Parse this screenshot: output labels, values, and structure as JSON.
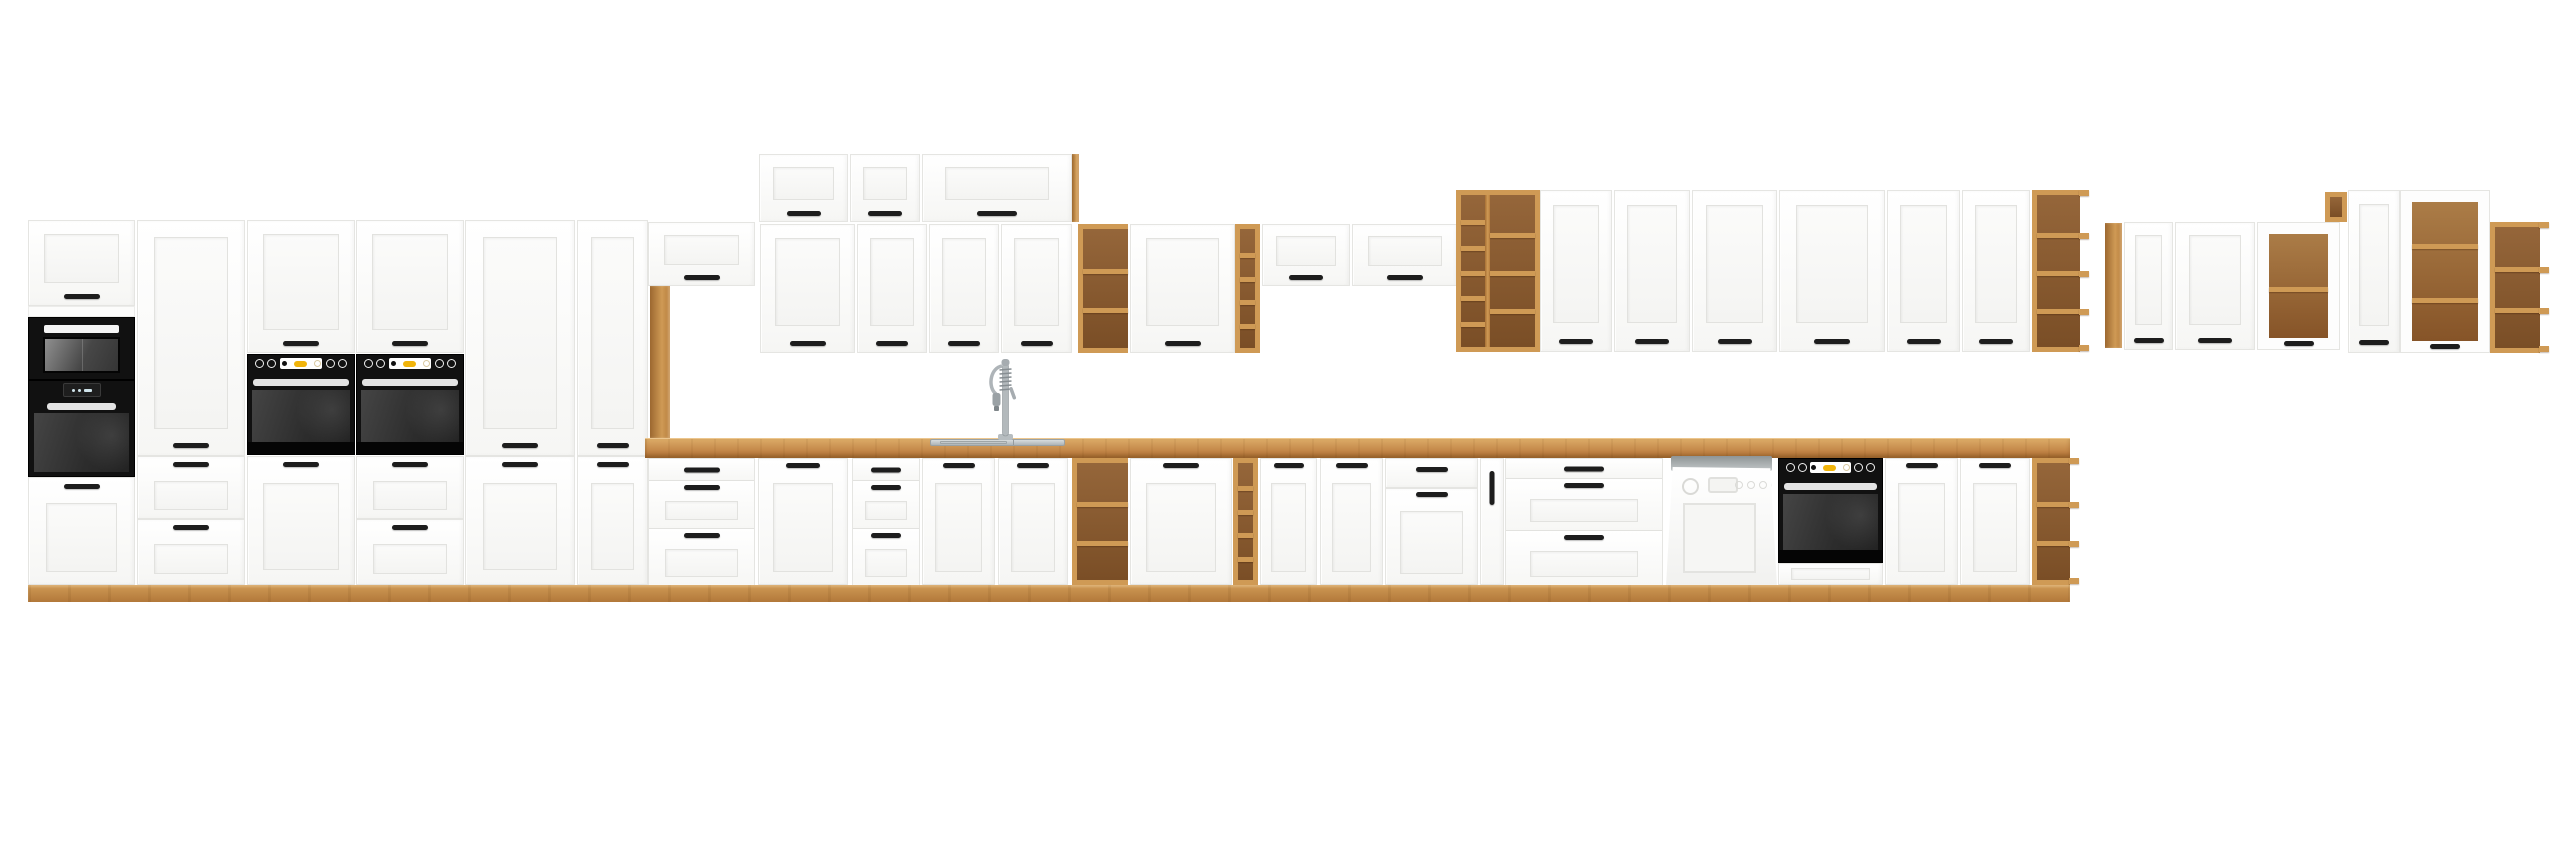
{
  "image": {
    "width": 2560,
    "height": 848,
    "background": "#ffffff",
    "subject": "white-and-oak-kitchen-cabinet-set"
  },
  "colors": {
    "oak-light": "#cf9a55",
    "oak": "#c4884a",
    "oak-dark": "#8a5a2e",
    "oak-deep": "#6e4520",
    "front": "#fdfdfd",
    "line": "#e5e5e2",
    "handle": "#1d1d1d",
    "appliance": "#161616",
    "glass": "#3a3a3a",
    "steel": "#c3c8cb",
    "accent-yellow": "#f1b40a",
    "dw-gray": "#b7bcbd"
  },
  "units": [
    {
      "name": "tall-oven-unit-top-door",
      "type": "door",
      "x": 28,
      "y": 220,
      "w": 107,
      "h": 86,
      "panel": [
        15,
        13,
        15,
        22
      ],
      "handle": {
        "side": "bottom",
        "w": 36,
        "off": 6
      }
    },
    {
      "name": "tall-oven-unit-filler",
      "type": "filler",
      "x": 28,
      "y": 306,
      "w": 107,
      "h": 11
    },
    {
      "name": "microwave",
      "type": "microwave",
      "x": 28,
      "y": 317,
      "w": 107,
      "h": 63
    },
    {
      "name": "built-in-oven-tall",
      "type": "oven-display",
      "x": 28,
      "y": 380,
      "w": 107,
      "h": 97
    },
    {
      "name": "tall-oven-unit-base-door",
      "type": "door",
      "x": 28,
      "y": 477,
      "w": 107,
      "h": 108,
      "panel": [
        17,
        25,
        17,
        12
      ],
      "handle": {
        "side": "top",
        "w": 36,
        "off": 6
      }
    },
    {
      "name": "pantry-upper-door",
      "type": "door",
      "x": 137,
      "y": 220,
      "w": 108,
      "h": 236,
      "panel": [
        16,
        16,
        16,
        26
      ],
      "handle": {
        "side": "bottom",
        "w": 36,
        "off": 7
      }
    },
    {
      "name": "pantry-drawer-1",
      "type": "door",
      "x": 137,
      "y": 456,
      "w": 108,
      "h": 63,
      "panel": [
        16,
        24,
        16,
        8
      ],
      "handle": {
        "side": "top",
        "w": 36,
        "off": 5
      }
    },
    {
      "name": "pantry-drawer-2",
      "type": "door",
      "x": 137,
      "y": 519,
      "w": 108,
      "h": 66,
      "panel": [
        16,
        24,
        16,
        10
      ],
      "handle": {
        "side": "top",
        "w": 36,
        "off": 5
      }
    },
    {
      "name": "oven-column-1-wall-door",
      "type": "door",
      "x": 247,
      "y": 220,
      "w": 108,
      "h": 133,
      "panel": [
        15,
        13,
        15,
        22
      ],
      "handle": {
        "side": "bottom",
        "w": 36,
        "off": 6
      }
    },
    {
      "name": "built-in-oven-1",
      "type": "oven",
      "x": 247,
      "y": 354,
      "w": 108,
      "h": 101
    },
    {
      "name": "oven-column-1-base-door",
      "type": "door",
      "x": 247,
      "y": 456,
      "w": 108,
      "h": 129,
      "panel": [
        15,
        26,
        15,
        14
      ],
      "handle": {
        "side": "top",
        "w": 36,
        "off": 5
      }
    },
    {
      "name": "oven-column-2-wall-door",
      "type": "door",
      "x": 356,
      "y": 220,
      "w": 108,
      "h": 133,
      "panel": [
        15,
        13,
        15,
        22
      ],
      "handle": {
        "side": "bottom",
        "w": 36,
        "off": 6
      }
    },
    {
      "name": "built-in-oven-2",
      "type": "oven",
      "x": 356,
      "y": 354,
      "w": 108,
      "h": 101
    },
    {
      "name": "oven-column-2-drawer-1",
      "type": "door",
      "x": 356,
      "y": 456,
      "w": 108,
      "h": 63,
      "panel": [
        16,
        24,
        16,
        8
      ],
      "handle": {
        "side": "top",
        "w": 36,
        "off": 5
      }
    },
    {
      "name": "oven-column-2-drawer-2",
      "type": "door",
      "x": 356,
      "y": 519,
      "w": 108,
      "h": 66,
      "panel": [
        16,
        24,
        16,
        10
      ],
      "handle": {
        "side": "top",
        "w": 36,
        "off": 5
      }
    },
    {
      "name": "tall-cabinet-1-upper-door",
      "type": "door",
      "x": 465,
      "y": 220,
      "w": 110,
      "h": 236,
      "panel": [
        17,
        16,
        17,
        26
      ],
      "handle": {
        "side": "bottom",
        "w": 36,
        "off": 7
      }
    },
    {
      "name": "tall-cabinet-1-lower-door",
      "type": "door",
      "x": 465,
      "y": 456,
      "w": 110,
      "h": 129,
      "panel": [
        17,
        26,
        17,
        14
      ],
      "handle": {
        "side": "top",
        "w": 36,
        "off": 5
      }
    },
    {
      "name": "tall-cabinet-2-upper-door",
      "type": "door",
      "x": 577,
      "y": 220,
      "w": 71,
      "h": 236,
      "panel": [
        13,
        16,
        13,
        26
      ],
      "handle": {
        "side": "bottom",
        "w": 32,
        "off": 7
      }
    },
    {
      "name": "tall-cabinet-2-lower-door",
      "type": "door",
      "x": 577,
      "y": 456,
      "w": 71,
      "h": 129,
      "panel": [
        13,
        26,
        13,
        14
      ],
      "handle": {
        "side": "top",
        "w": 32,
        "off": 5
      }
    },
    {
      "name": "wall-cabinet-over-post",
      "type": "door",
      "x": 648,
      "y": 222,
      "w": 107,
      "h": 64,
      "panel": [
        15,
        12,
        15,
        20
      ],
      "handle": {
        "side": "bottom",
        "w": 36,
        "off": 5
      }
    },
    {
      "name": "oak-post",
      "type": "oak-panel",
      "x": 650,
      "y": 286,
      "w": 20,
      "h": 152
    },
    {
      "name": "wall-top-cabinet-1",
      "type": "door",
      "x": 759,
      "y": 154,
      "w": 89,
      "h": 68,
      "panel": [
        13,
        12,
        13,
        21
      ],
      "handle": {
        "side": "bottom",
        "w": 34,
        "off": 5
      }
    },
    {
      "name": "wall-top-cabinet-2",
      "type": "door",
      "x": 850,
      "y": 154,
      "w": 70,
      "h": 68,
      "panel": [
        12,
        12,
        12,
        21
      ],
      "handle": {
        "side": "bottom",
        "w": 34,
        "off": 5
      }
    },
    {
      "name": "wall-top-cabinet-3",
      "type": "door",
      "x": 922,
      "y": 154,
      "w": 150,
      "h": 68,
      "panel": [
        22,
        12,
        22,
        21
      ],
      "handle": {
        "side": "bottom",
        "w": 40,
        "off": 5
      }
    },
    {
      "name": "wall-top-oak-end-panel",
      "type": "oak-panel",
      "x": 1072,
      "y": 154,
      "w": 7,
      "h": 68
    },
    {
      "name": "wall-door-1",
      "type": "door",
      "x": 760,
      "y": 224,
      "w": 95,
      "h": 129,
      "panel": [
        14,
        13,
        14,
        26
      ],
      "handle": {
        "side": "bottom",
        "w": 36,
        "off": 6
      }
    },
    {
      "name": "wall-door-2",
      "type": "door",
      "x": 857,
      "y": 224,
      "w": 70,
      "h": 129,
      "panel": [
        12,
        13,
        12,
        26
      ],
      "handle": {
        "side": "bottom",
        "w": 32,
        "off": 6
      }
    },
    {
      "name": "wall-door-3",
      "type": "door",
      "x": 929,
      "y": 224,
      "w": 70,
      "h": 129,
      "panel": [
        12,
        13,
        12,
        26
      ],
      "handle": {
        "side": "bottom",
        "w": 32,
        "off": 6
      }
    },
    {
      "name": "wall-door-4",
      "type": "door",
      "x": 1001,
      "y": 224,
      "w": 71,
      "h": 129,
      "panel": [
        12,
        13,
        12,
        26
      ],
      "handle": {
        "side": "bottom",
        "w": 32,
        "off": 6
      }
    },
    {
      "name": "wall-open-shelf",
      "type": "shelf-unit",
      "x": 1078,
      "y": 224,
      "w": 50,
      "h": 129,
      "cells": 3,
      "openRight": true
    },
    {
      "name": "wall-door-5",
      "type": "door",
      "x": 1130,
      "y": 224,
      "w": 105,
      "h": 129,
      "panel": [
        15,
        13,
        15,
        26
      ],
      "handle": {
        "side": "bottom",
        "w": 36,
        "off": 6
      }
    },
    {
      "name": "wall-oak-column",
      "type": "shelf-unit",
      "x": 1235,
      "y": 224,
      "w": 25,
      "h": 129,
      "cells": 5
    },
    {
      "name": "wall-cabinet-short-1",
      "type": "door",
      "x": 1262,
      "y": 224,
      "w": 88,
      "h": 62,
      "panel": [
        13,
        11,
        13,
        19
      ],
      "handle": {
        "side": "bottom",
        "w": 34,
        "off": 5
      }
    },
    {
      "name": "wall-cabinet-short-2",
      "type": "door",
      "x": 1352,
      "y": 224,
      "w": 106,
      "h": 62,
      "panel": [
        15,
        11,
        15,
        19
      ],
      "handle": {
        "side": "bottom",
        "w": 36,
        "off": 5
      }
    },
    {
      "name": "oak-shelf-tower",
      "type": "oak-tower",
      "x": 1456,
      "y": 190,
      "w": 84,
      "h": 162
    },
    {
      "name": "wall-tall-door-1",
      "type": "door",
      "x": 1540,
      "y": 190,
      "w": 72,
      "h": 162,
      "panel": [
        12,
        14,
        12,
        28
      ],
      "handle": {
        "side": "bottom",
        "w": 34,
        "off": 7
      }
    },
    {
      "name": "wall-tall-door-2",
      "type": "door",
      "x": 1614,
      "y": 190,
      "w": 76,
      "h": 162,
      "panel": [
        12,
        14,
        12,
        28
      ],
      "handle": {
        "side": "bottom",
        "w": 34,
        "off": 7
      }
    },
    {
      "name": "wall-tall-door-3",
      "type": "door",
      "x": 1692,
      "y": 190,
      "w": 85,
      "h": 162,
      "panel": [
        13,
        14,
        13,
        28
      ],
      "handle": {
        "side": "bottom",
        "w": 34,
        "off": 7
      }
    },
    {
      "name": "wall-tall-door-4",
      "type": "door",
      "x": 1779,
      "y": 190,
      "w": 106,
      "h": 162,
      "panel": [
        16,
        14,
        16,
        28
      ],
      "handle": {
        "side": "bottom",
        "w": 36,
        "off": 7
      }
    },
    {
      "name": "wall-tall-door-5",
      "type": "door",
      "x": 1887,
      "y": 190,
      "w": 73,
      "h": 162,
      "panel": [
        12,
        14,
        12,
        28
      ],
      "handle": {
        "side": "bottom",
        "w": 34,
        "off": 7
      }
    },
    {
      "name": "wall-tall-door-6",
      "type": "door",
      "x": 1962,
      "y": 190,
      "w": 68,
      "h": 162,
      "panel": [
        12,
        14,
        12,
        28
      ],
      "handle": {
        "side": "bottom",
        "w": 34,
        "off": 7
      }
    },
    {
      "name": "wall-oak-end-shelf",
      "type": "shelf-unit",
      "x": 2032,
      "y": 190,
      "w": 48,
      "h": 162,
      "cells": 4,
      "openRight": true,
      "lips": true
    },
    {
      "name": "right-group-oak-side-panel",
      "type": "oak-panel",
      "x": 2105,
      "y": 223,
      "w": 17,
      "h": 125
    },
    {
      "name": "right-wall-door-1",
      "type": "door",
      "x": 2124,
      "y": 222,
      "w": 49,
      "h": 128,
      "panel": [
        10,
        12,
        10,
        24
      ],
      "handle": {
        "side": "bottom",
        "w": 30,
        "off": 6
      }
    },
    {
      "name": "right-wall-door-2",
      "type": "door",
      "x": 2175,
      "y": 222,
      "w": 80,
      "h": 128,
      "panel": [
        13,
        12,
        13,
        24
      ],
      "handle": {
        "side": "bottom",
        "w": 34,
        "off": 6
      }
    },
    {
      "name": "right-display-cabinet-1",
      "type": "vitrine",
      "x": 2257,
      "y": 222,
      "w": 83,
      "h": 128,
      "shelves": [
        0.5
      ]
    },
    {
      "name": "right-oak-mini-shelf",
      "type": "shelf-unit",
      "x": 2325,
      "y": 192,
      "w": 22,
      "h": 30,
      "cells": 1
    },
    {
      "name": "right2-wall-door",
      "type": "door",
      "x": 2348,
      "y": 190,
      "w": 52,
      "h": 163,
      "panel": [
        10,
        13,
        10,
        26
      ],
      "handle": {
        "side": "bottom",
        "w": 30,
        "off": 7
      }
    },
    {
      "name": "right-display-cabinet-2",
      "type": "vitrine",
      "x": 2400,
      "y": 190,
      "w": 90,
      "h": 163,
      "shelves": [
        0.3,
        0.68
      ]
    },
    {
      "name": "right-oak-corner-shelf",
      "type": "shelf-unit",
      "x": 2490,
      "y": 222,
      "w": 50,
      "h": 131,
      "cells": 3,
      "openRight": true,
      "lips": true
    },
    {
      "name": "countertop",
      "type": "countertop",
      "x": 645,
      "y": 438,
      "w": 1425,
      "h": 20
    },
    {
      "name": "sink",
      "type": "sink",
      "x": 930,
      "y": 439,
      "w": 135,
      "h": 7
    },
    {
      "name": "kitchen-faucet",
      "type": "faucet",
      "x": 985,
      "y": 357,
      "w": 40,
      "h": 83
    },
    {
      "name": "base-drawers-1",
      "type": "drawers3",
      "x": 648,
      "y": 458,
      "w": 107,
      "h": 127,
      "rows": [
        22,
        48,
        57
      ],
      "hw": 36,
      "pw": 16
    },
    {
      "name": "base-door-1",
      "type": "door",
      "x": 758,
      "y": 458,
      "w": 90,
      "h": 127,
      "panel": [
        14,
        24,
        14,
        12
      ],
      "handle": {
        "side": "top",
        "w": 34,
        "off": 4
      }
    },
    {
      "name": "base-drawers-2",
      "type": "drawers3",
      "x": 852,
      "y": 458,
      "w": 68,
      "h": 127,
      "rows": [
        22,
        48,
        57
      ],
      "hw": 30,
      "pw": 12
    },
    {
      "name": "sink-base-door-1",
      "type": "door",
      "x": 922,
      "y": 458,
      "w": 73,
      "h": 127,
      "panel": [
        12,
        24,
        12,
        12
      ],
      "handle": {
        "side": "top",
        "w": 32,
        "off": 4
      }
    },
    {
      "name": "sink-base-door-2",
      "type": "door",
      "x": 998,
      "y": 458,
      "w": 70,
      "h": 127,
      "panel": [
        12,
        24,
        12,
        12
      ],
      "handle": {
        "side": "top",
        "w": 32,
        "off": 4
      }
    },
    {
      "name": "base-open-shelf",
      "type": "shelf-unit",
      "x": 1072,
      "y": 458,
      "w": 56,
      "h": 127,
      "cells": 3,
      "openRight": true
    },
    {
      "name": "base-door-2",
      "type": "door",
      "x": 1130,
      "y": 458,
      "w": 102,
      "h": 127,
      "panel": [
        15,
        24,
        15,
        12
      ],
      "handle": {
        "side": "top",
        "w": 36,
        "off": 4
      }
    },
    {
      "name": "base-oak-column",
      "type": "shelf-unit",
      "x": 1233,
      "y": 458,
      "w": 25,
      "h": 127,
      "cells": 5
    },
    {
      "name": "base-door-3",
      "type": "door",
      "x": 1260,
      "y": 458,
      "w": 57,
      "h": 127,
      "panel": [
        10,
        24,
        10,
        12
      ],
      "handle": {
        "side": "top",
        "w": 30,
        "off": 4
      }
    },
    {
      "name": "base-door-4",
      "type": "door",
      "x": 1320,
      "y": 458,
      "w": 63,
      "h": 127,
      "panel": [
        11,
        24,
        11,
        12
      ],
      "handle": {
        "side": "top",
        "w": 32,
        "off": 4
      }
    },
    {
      "name": "base-combi-top-drawer",
      "type": "door",
      "x": 1385,
      "y": 458,
      "w": 93,
      "h": 30,
      "handle": {
        "side": "top",
        "w": 32,
        "off": 8
      }
    },
    {
      "name": "base-combi-door",
      "type": "door",
      "x": 1385,
      "y": 488,
      "w": 93,
      "h": 97,
      "panel": [
        14,
        22,
        14,
        10
      ],
      "handle": {
        "side": "top",
        "w": 32,
        "off": 3
      }
    },
    {
      "name": "base-cargo-door",
      "type": "door",
      "x": 1480,
      "y": 458,
      "w": 24,
      "h": 127,
      "handle": {
        "side": "vert",
        "w": 34,
        "off": 12
      }
    },
    {
      "name": "base-drawers-wide",
      "type": "drawers3",
      "x": 1505,
      "y": 458,
      "w": 158,
      "h": 127,
      "rows": [
        20,
        52,
        55
      ],
      "hw": 40,
      "pw": 24
    },
    {
      "name": "dishwasher",
      "type": "dishwasher",
      "x": 1665,
      "y": 456,
      "w": 115,
      "h": 130
    },
    {
      "name": "built-in-oven-base",
      "type": "oven",
      "x": 1778,
      "y": 458,
      "w": 105,
      "h": 105
    },
    {
      "name": "oven-base-drawer",
      "type": "door",
      "x": 1778,
      "y": 563,
      "w": 105,
      "h": 22,
      "panel": [
        12,
        4,
        12,
        4
      ]
    },
    {
      "name": "base-door-5",
      "type": "door",
      "x": 1885,
      "y": 458,
      "w": 73,
      "h": 127,
      "panel": [
        12,
        24,
        12,
        12
      ],
      "handle": {
        "side": "top",
        "w": 32,
        "off": 4
      }
    },
    {
      "name": "base-door-6",
      "type": "door",
      "x": 1960,
      "y": 458,
      "w": 70,
      "h": 127,
      "panel": [
        12,
        24,
        12,
        12
      ],
      "handle": {
        "side": "top",
        "w": 32,
        "off": 4
      }
    },
    {
      "name": "base-oak-end-shelf",
      "type": "shelf-unit",
      "x": 2032,
      "y": 458,
      "w": 38,
      "h": 127,
      "cells": 3,
      "openRight": true,
      "lips": true
    },
    {
      "name": "plinth",
      "type": "plinth",
      "x": 28,
      "y": 585,
      "w": 2042,
      "h": 17
    }
  ]
}
